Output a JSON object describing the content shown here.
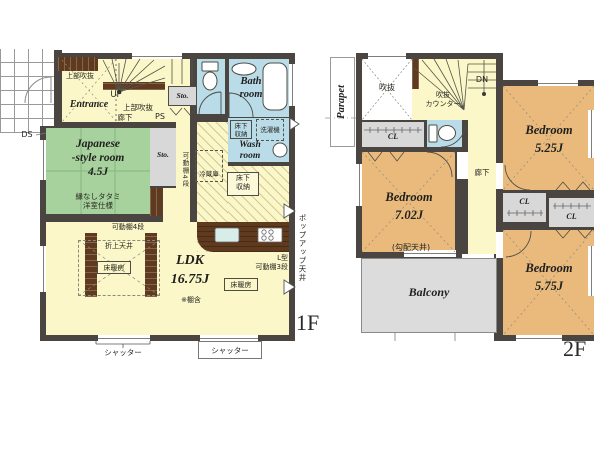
{
  "colors": {
    "wall": "#4a4541",
    "floor": "#fbf7c9",
    "tatami": "#a7d19d",
    "water": "#badce9",
    "storage": "#d8d8d8",
    "bedroom": "#eaba7d",
    "balcony": "#dcdcdc",
    "wood": "#5f3a1e"
  },
  "f1": {
    "floor_label": "1F",
    "entrance": "Entrance",
    "upper_void": "上部吹抜",
    "up": "UP",
    "sto": "Sto.",
    "hallway": "廊下",
    "ps": "PS",
    "ds": "DS",
    "bath": [
      "Bath",
      "room"
    ],
    "wash": [
      "Wash",
      "room"
    ],
    "underfloor": [
      "床下",
      "収納"
    ],
    "washer": "洗濯機",
    "fridge": "冷蔵庫",
    "jp_room": [
      "Japanese",
      "-style room",
      "4.5J"
    ],
    "jp_note": [
      "縁なしタタミ",
      "洋室仕様"
    ],
    "shelf4": "可動棚4段",
    "shelf3": [
      "L型",
      "可動棚3段"
    ],
    "ldk": [
      "LDK",
      "16.75J"
    ],
    "ldk_note": "※棚含",
    "heating": "床暖房",
    "coffered": "折上天井",
    "shutter": "シャッター",
    "popup": "ポップアップ天井"
  },
  "f2": {
    "floor_label": "2F",
    "parapet": "Parapet",
    "void": "吹抜",
    "void_counter": [
      "吹抜",
      "カウンター"
    ],
    "dn": "DN",
    "closet": "CL",
    "hallway": "廊下",
    "bed1": [
      "Bedroom",
      "7.02J"
    ],
    "slope_note": "(勾配天井)",
    "bed2": [
      "Bedroom",
      "5.25J"
    ],
    "bed3": [
      "Bedroom",
      "5.75J"
    ],
    "balcony": "Balcony"
  }
}
